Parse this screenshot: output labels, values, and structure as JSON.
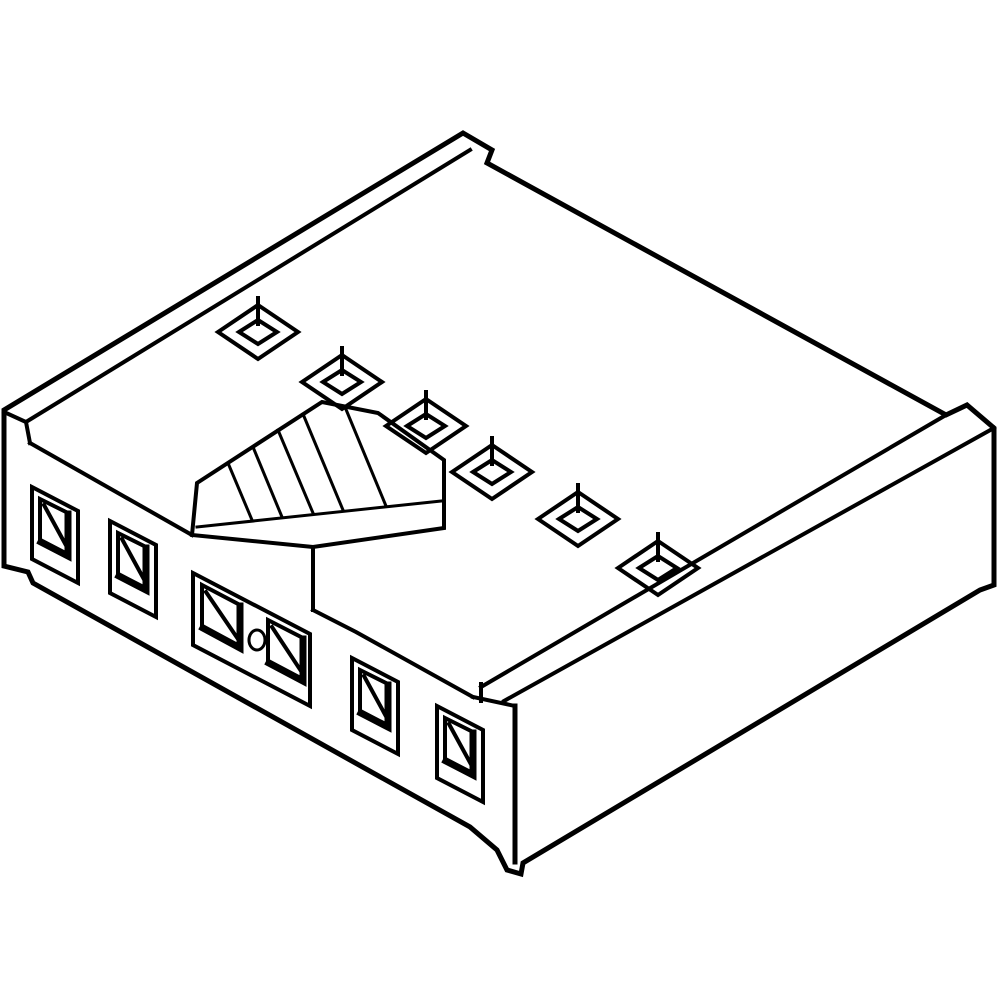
{
  "meta": {
    "title": "Connector housing isometric line drawing",
    "description": "Black line-art isometric technical illustration of a 6-circuit female crimp connector housing: polarization rail along the upper-left edge, six square terminal openings across the top face, a serrated latch ramp block in the center, six rectangular terminal cavities on the front face (center two merged with a circular polarizing hole), blank right face.",
    "background": "#ffffff",
    "line_color": "#000000"
  },
  "drawing": {
    "viewbox": "0 0 1000 1000",
    "paths": [
      {
        "n": "body-silhouette",
        "d": "M4 410 L463 133 L492 150 L487 163 L946 415 L967 405 L994 428 L994 585 L980 590 L523 863 L521 874 L507 870 L497 850 L470 827 L33 583 L28 572 L4 566 Z",
        "sw": 5,
        "f": "#ffffff"
      },
      {
        "n": "rail-inner-edge",
        "d": "M26 422 L470 150",
        "sw": 4
      },
      {
        "n": "rail-left-cap",
        "d": "M4 412 L26 422 L30 443",
        "sw": 4
      },
      {
        "n": "top-face-front-edge-left",
        "d": "M30 443 L192 535",
        "sw": 4
      },
      {
        "n": "latch-block-outline",
        "d": "M192 535 L197 483 L322 402 L378 413 L444 460 L444 528 L313 547 Z",
        "sw": 4
      },
      {
        "n": "latch-block-hatch-base",
        "d": "M197 527 L441 501",
        "sw": 3
      },
      {
        "n": "latch-block-hatch-1",
        "d": "M228 463 L252 520",
        "sw": 3
      },
      {
        "n": "latch-block-hatch-2",
        "d": "M253 447 L282 517",
        "sw": 3
      },
      {
        "n": "latch-block-hatch-3",
        "d": "M278 430 L313 513",
        "sw": 3
      },
      {
        "n": "latch-block-hatch-4",
        "d": "M303 414 L343 510",
        "sw": 3
      },
      {
        "n": "latch-block-hatch-5",
        "d": "M345 407 L386 506",
        "sw": 3
      },
      {
        "n": "latch-block-lower-vertical",
        "d": "M313 547 L313 610",
        "sw": 4
      },
      {
        "n": "front-face-top-edge-right",
        "d": "M313 610 L356 632 L473 697",
        "sw": 4
      },
      {
        "n": "right-face-lip-upper",
        "d": "M481 687 L946 415",
        "sw": 4
      },
      {
        "n": "right-face-lip-lower",
        "d": "M504 701 L994 428",
        "sw": 4
      },
      {
        "n": "right-face-lip-cap",
        "d": "M481 684 L481 701",
        "sw": 4
      },
      {
        "n": "right-face-lip-under",
        "d": "M473 697 L515 706",
        "sw": 4
      },
      {
        "n": "front-corner-vertical",
        "d": "M515 706 L515 862",
        "sw": 5
      },
      {
        "n": "top-square-hole-1",
        "d": "M218 332 L258 305 L298 332 L258 359 Z M239 332 L258 320 L277 332 L258 344 Z M258 298 L258 324",
        "sw": 4
      },
      {
        "n": "top-square-hole-2",
        "d": "M302 382 L342 355 L382 382 L342 409 Z M323 382 L342 370 L361 382 L342 394 Z M342 348 L342 374",
        "sw": 4
      },
      {
        "n": "top-square-hole-3",
        "d": "M386 426 L426 399 L466 426 L426 453 Z M407 426 L426 414 L445 426 L426 438 Z M426 392 L426 418",
        "sw": 4
      },
      {
        "n": "top-square-hole-4",
        "d": "M452 472 L492 445 L532 472 L492 499 Z M473 472 L492 460 L511 472 L492 484 Z M492 438 L492 464",
        "sw": 4
      },
      {
        "n": "top-square-hole-5",
        "d": "M538 519 L578 492 L618 519 L578 546 Z M559 519 L578 507 L597 519 L578 531 Z M578 485 L578 511",
        "sw": 4
      },
      {
        "n": "top-square-hole-6",
        "d": "M618 568 L658 541 L698 568 L658 595 Z M639 568 L658 556 L677 568 L658 580 Z M658 534 L658 560",
        "sw": 4
      },
      {
        "n": "cavity-1-frame",
        "d": "M32 487 L78 511 L78 583 L32 559 Z M40 499 L68 513 L68 557 L40 543 Z",
        "sw": 4
      },
      {
        "n": "cavity-1-shadow",
        "d": "M68 514 L68 556 L41 542",
        "sw": 7
      },
      {
        "n": "cavity-1-chamfer",
        "d": "M44 505 L68 549",
        "sw": 4
      },
      {
        "n": "cavity-2-frame",
        "d": "M110 521 L156 545 L156 617 L110 593 Z M118 533 L146 547 L146 591 L118 577 Z",
        "sw": 4
      },
      {
        "n": "cavity-2-shadow",
        "d": "M146 548 L146 590 L119 576",
        "sw": 7
      },
      {
        "n": "cavity-2-chamfer",
        "d": "M122 539 L146 583",
        "sw": 4
      },
      {
        "n": "cavity-center-frame",
        "d": "M193 573 L310 634 L310 706 L193 645 Z M202 585 L240 605 L240 649 L202 629 Z M268 620 L303 638 L303 682 L268 664 Z",
        "sw": 4
      },
      {
        "n": "cavity-center-shadow-left",
        "d": "M240 606 L240 648 L203 628",
        "sw": 7
      },
      {
        "n": "cavity-center-chamfer-left",
        "d": "M206 592 L240 642",
        "sw": 4
      },
      {
        "n": "cavity-center-shadow-right",
        "d": "M303 639 L303 681 L269 663",
        "sw": 7
      },
      {
        "n": "cavity-center-chamfer-right",
        "d": "M272 627 L303 674",
        "sw": 4
      },
      {
        "n": "cavity-center-polarizing-hole",
        "d": "M249 640 a8 10 0 1 0 16 0 a8 10 0 1 0 -16 0",
        "sw": 3
      },
      {
        "n": "cavity-5-frame",
        "d": "M352 658 L398 682 L398 754 L352 730 Z M360 670 L388 684 L388 728 L360 714 Z",
        "sw": 4
      },
      {
        "n": "cavity-5-shadow",
        "d": "M388 685 L388 727 L361 713",
        "sw": 7
      },
      {
        "n": "cavity-5-chamfer",
        "d": "M364 676 L388 720",
        "sw": 4
      },
      {
        "n": "cavity-6-frame",
        "d": "M437 706 L483 730 L483 802 L437 778 Z M445 718 L473 732 L473 776 L445 762 Z",
        "sw": 4
      },
      {
        "n": "cavity-6-shadow",
        "d": "M473 733 L473 775 L446 761",
        "sw": 7
      },
      {
        "n": "cavity-6-chamfer",
        "d": "M449 724 L473 768",
        "sw": 4
      }
    ]
  }
}
